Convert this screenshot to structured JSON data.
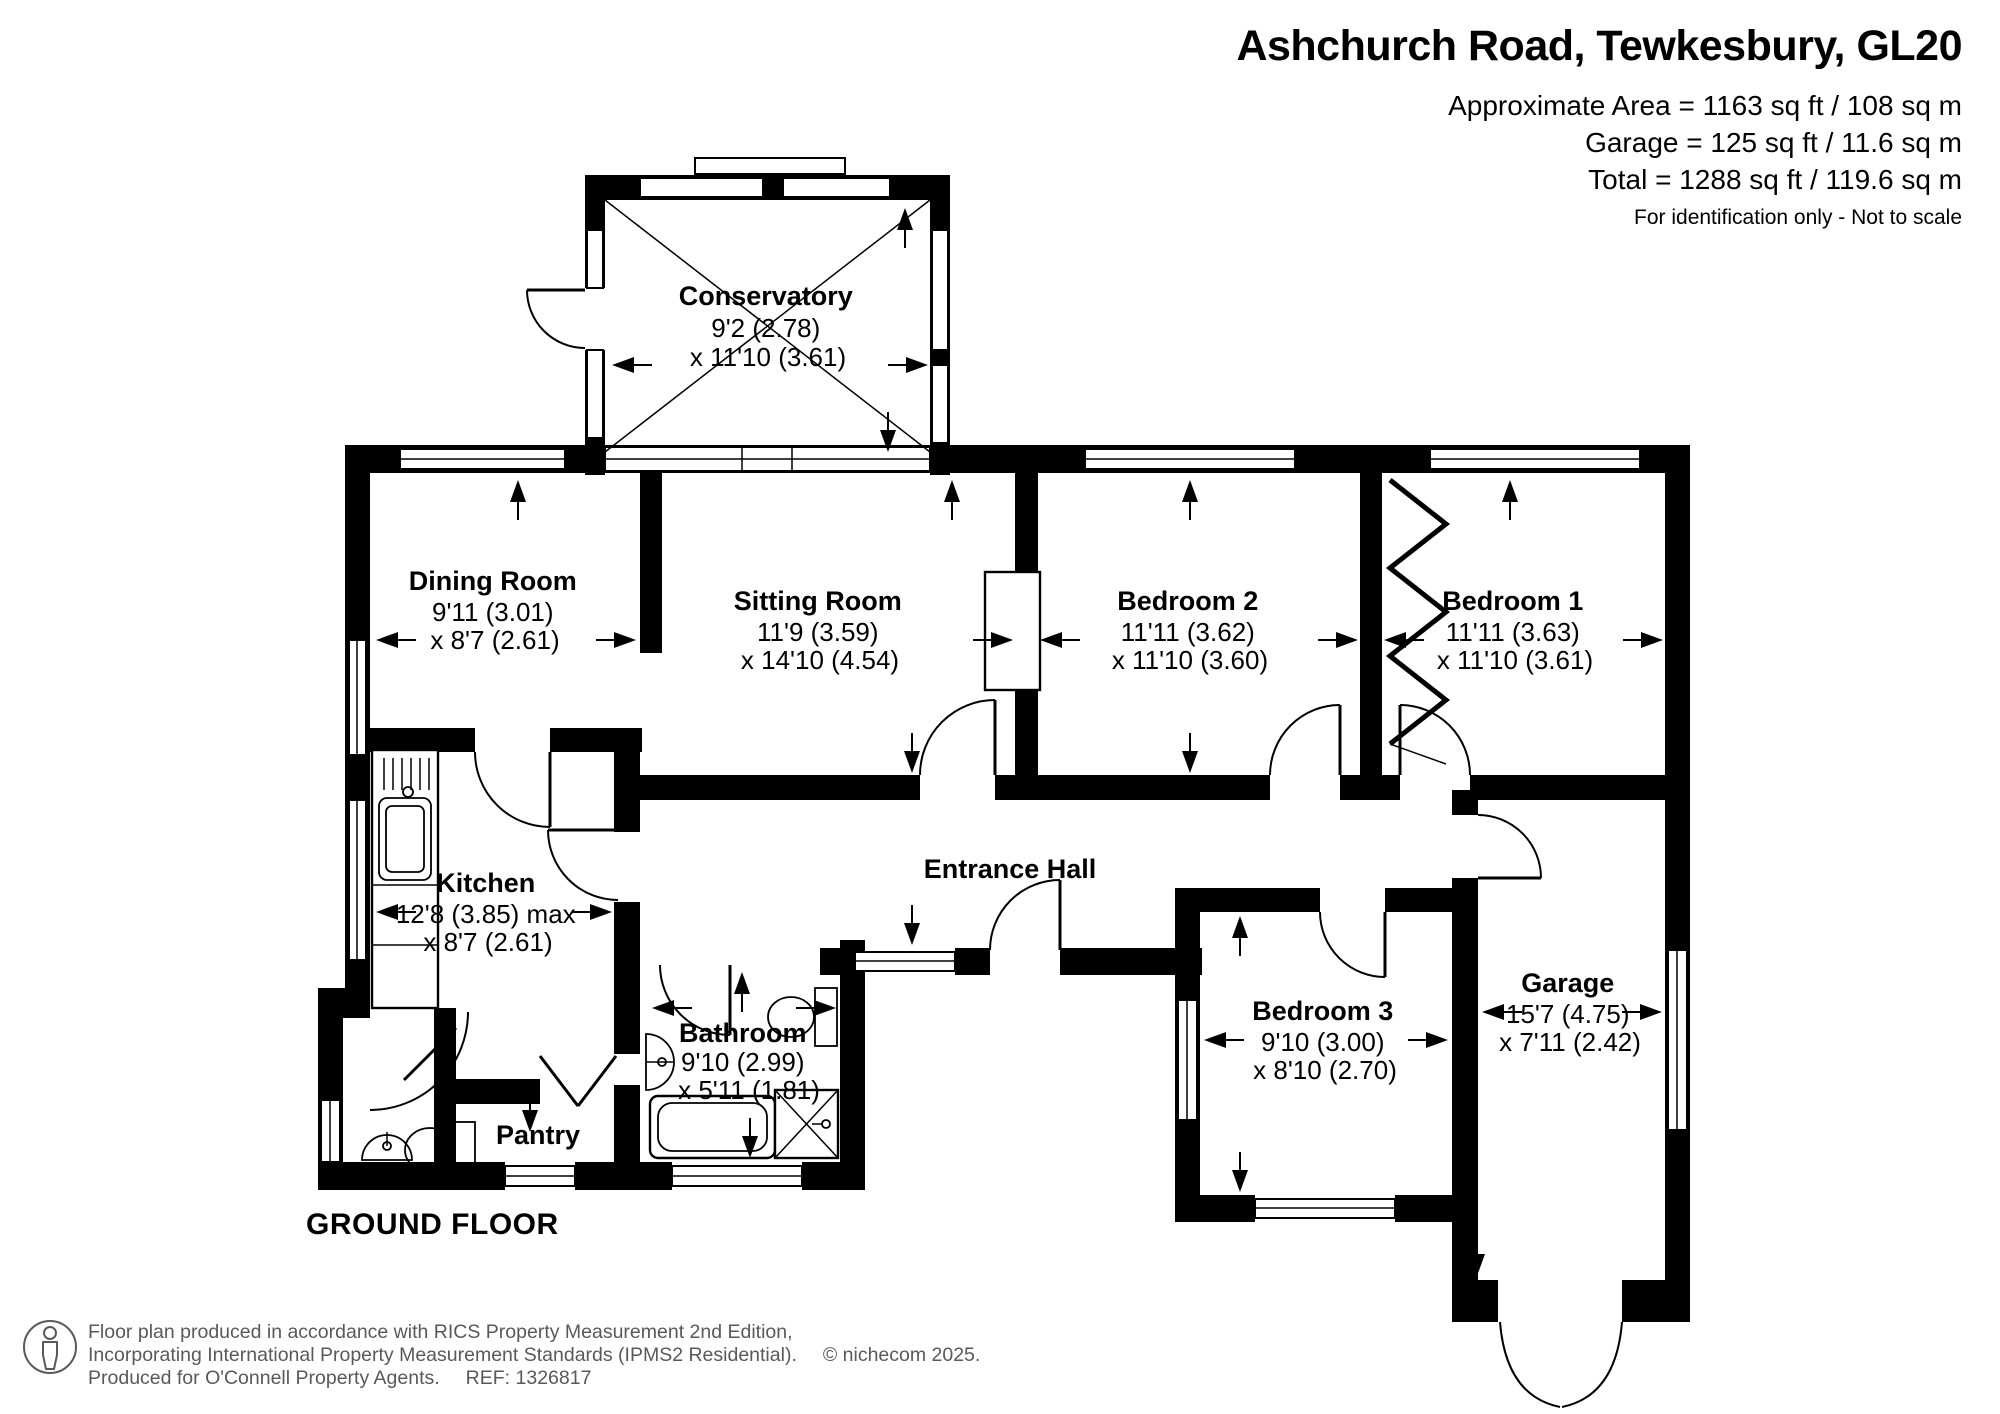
{
  "header": {
    "title": "Ashchurch Road, Tewkesbury, GL20",
    "area_line1": "Approximate Area = 1163 sq ft / 108 sq m",
    "area_line2": "Garage = 125 sq ft / 11.6 sq m",
    "area_line3": "Total = 1288 sq ft / 119.6 sq m",
    "disclaimer": "For identification only - Not to scale"
  },
  "floor_label": "GROUND FLOOR",
  "rooms": [
    {
      "name": "Conservatory",
      "dim1": "9'2 (2.78)",
      "dim2": "x 11'10 (3.61)"
    },
    {
      "name": "Dining Room",
      "dim1": "9'11 (3.01)",
      "dim2": "x 8'7 (2.61)"
    },
    {
      "name": "Sitting Room",
      "dim1": "11'9 (3.59)",
      "dim2": "x 14'10 (4.54)"
    },
    {
      "name": "Bedroom 2",
      "dim1": "11'11 (3.62)",
      "dim2": "x 11'10 (3.60)"
    },
    {
      "name": "Bedroom 1",
      "dim1": "11'11 (3.63)",
      "dim2": "x 11'10 (3.61)"
    },
    {
      "name": "Kitchen",
      "dim1": "12'8 (3.85) max",
      "dim2": "x 8'7 (2.61)"
    },
    {
      "name": "Entrance Hall"
    },
    {
      "name": "Bathroom",
      "dim1": "9'10 (2.99)",
      "dim2": "x 5'11 (1.81)"
    },
    {
      "name": "Pantry"
    },
    {
      "name": "Bedroom 3",
      "dim1": "9'10 (3.00)",
      "dim2": "x 8'10 (2.70)"
    },
    {
      "name": "Garage",
      "dim1": "15'7 (4.75)",
      "dim2": "x 7'11 (2.42)"
    }
  ],
  "footer": {
    "line1": "Floor plan produced in accordance with RICS Property Measurement 2nd Edition,",
    "line2": "Incorporating International Property Measurement Standards (IPMS2 Residential).",
    "copyright": "© nichecom 2025.",
    "line3": "Produced for O'Connell Property Agents.",
    "ref": "REF: 1326817"
  }
}
